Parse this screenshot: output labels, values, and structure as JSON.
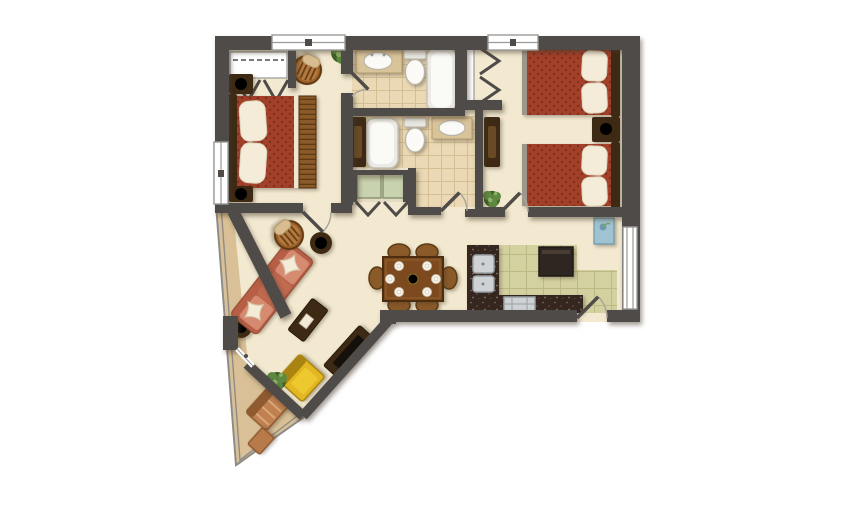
{
  "title": "Two Bedroom, Two Bath Suite Floor Plan",
  "type": "floor-plan",
  "colors": {
    "wall": "#4e4b48",
    "floor": "#f2e9d0",
    "balcony_floor": "#d9c096",
    "bath_tile": "#ead9b4",
    "bath_tile_line": "#d4bf94",
    "kitchen_tile": "#d3d1a0",
    "kitchen_tile_line": "#bcba84",
    "granite": "#362620",
    "granite_speckle": "#8a7666",
    "bed_red": "#a3402a",
    "bed_red_dark": "#7e2f1c",
    "pillow": "#f4ecd8",
    "wood": "#8a5a28",
    "wood_dark": "#5d3a14",
    "dark_wood": "#3e2a14",
    "sofa": "#d68a70",
    "sofa_dark": "#c06a50",
    "sofa_back": "#b65f46",
    "yellow": "#e2b722",
    "yellow_dark": "#a98410",
    "yellow_light": "#edc82e",
    "plant": "#5d8a40",
    "plant_dark": "#3f6128",
    "copper": "#c08050",
    "copper_dark": "#8f5a30",
    "white_fixture": "#fbfaf6",
    "fixture_line": "#b9b4a8",
    "stainless": "#cfd2d4",
    "stainless_dark": "#9aa0a4",
    "railing": "#8f8c86",
    "arc": "#a8a29a",
    "blue_art": "#9fc3d2",
    "blue_art_dark": "#6f98ab",
    "counter_tan": "#d9c49a",
    "window_white": "#ffffff",
    "window_frame": "#9a9a96"
  },
  "rooms": {
    "master_bedroom": {
      "name": "Master Bedroom",
      "furniture": [
        "queen bed",
        "nightstand with lamp (x2)",
        "bifold closet",
        "rattan armchair",
        "potted plant"
      ]
    },
    "bathroom_1": {
      "name": "Bathroom 1",
      "furniture": [
        "vanity sink",
        "toilet",
        "bathtub"
      ]
    },
    "bathroom_2": {
      "name": "Bathroom 2",
      "furniture": [
        "bathtub",
        "toilet",
        "vanity sink",
        "linen cabinet"
      ]
    },
    "utility_closet": {
      "name": "Utility Closet",
      "furniture": [
        "washer",
        "dryer"
      ]
    },
    "bedroom_2": {
      "name": "Second Bedroom",
      "furniture": [
        "double bed (x2)",
        "nightstand with lamp",
        "bifold closet",
        "dresser",
        "potted plant",
        "wall art"
      ]
    },
    "kitchen": {
      "name": "Kitchen",
      "furniture": [
        "L-shaped granite counter",
        "double sink",
        "range",
        "refrigerator"
      ]
    },
    "dining_area": {
      "name": "Dining Area",
      "furniture": [
        "dining table",
        "chair (x6)",
        "place setting (x6)",
        "centerpiece"
      ]
    },
    "living_room": {
      "name": "Living Room",
      "furniture": [
        "three-seat sofa",
        "throw pillow (x2)",
        "round end table with lamp (x2)",
        "coffee table",
        "media console with tv",
        "yellow armchair",
        "rattan side chair",
        "potted plant (x2)"
      ]
    },
    "balcony": {
      "name": "Wrap-around Balcony",
      "furniture": [
        "lounge chair",
        "side table",
        "potted plant",
        "railing"
      ]
    },
    "entry": {
      "name": "Entry",
      "furniture": [
        "entry door",
        "side window"
      ]
    }
  }
}
